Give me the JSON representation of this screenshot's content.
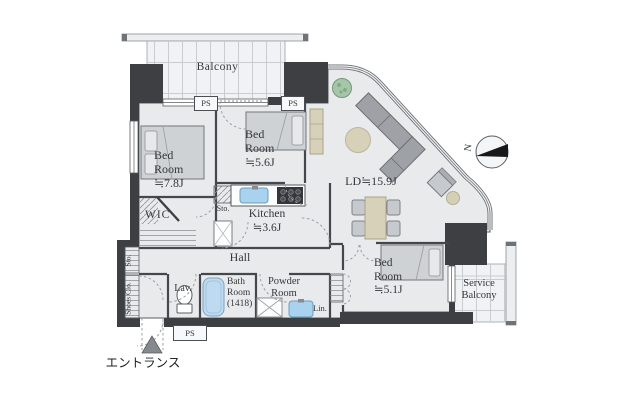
{
  "floor_plan": {
    "labels": {
      "balcony": "Balcony",
      "bedroom_78": "Bed\nRoom\n≒7.8J",
      "bedroom_56": "Bed\nRoom\n≒5.6J",
      "bedroom_51": "Bed\nRoom\n≒5.1J",
      "living_dining": "LD≒15.9J",
      "kitchen": "Kitchen\n≒3.6J",
      "wic": "WIC",
      "hall": "Hall",
      "storage_upper": "Sto.",
      "storage_entry": "Sto.",
      "shoes_closet": "Shoes Clo.",
      "lavatory": "Lav.",
      "bathroom": "Bath\nRoom\n(1418)",
      "powder_room": "Powder\nRoom",
      "linen": "Lin.",
      "service_balcony": "Service\nBalcony",
      "pipe_space": "PS",
      "compass_north": "N",
      "entrance": "エントランス"
    },
    "colors": {
      "wall": "#3d3f42",
      "floor": "#e9eaec",
      "balcony_floor": "#f1f2f3",
      "furniture_gray": "#c9ccd0",
      "wood_beige": "#d7d1ba",
      "water_blue": "#a9d2ee",
      "plant_green": "#a6c6aa",
      "text": "#34383c"
    }
  }
}
